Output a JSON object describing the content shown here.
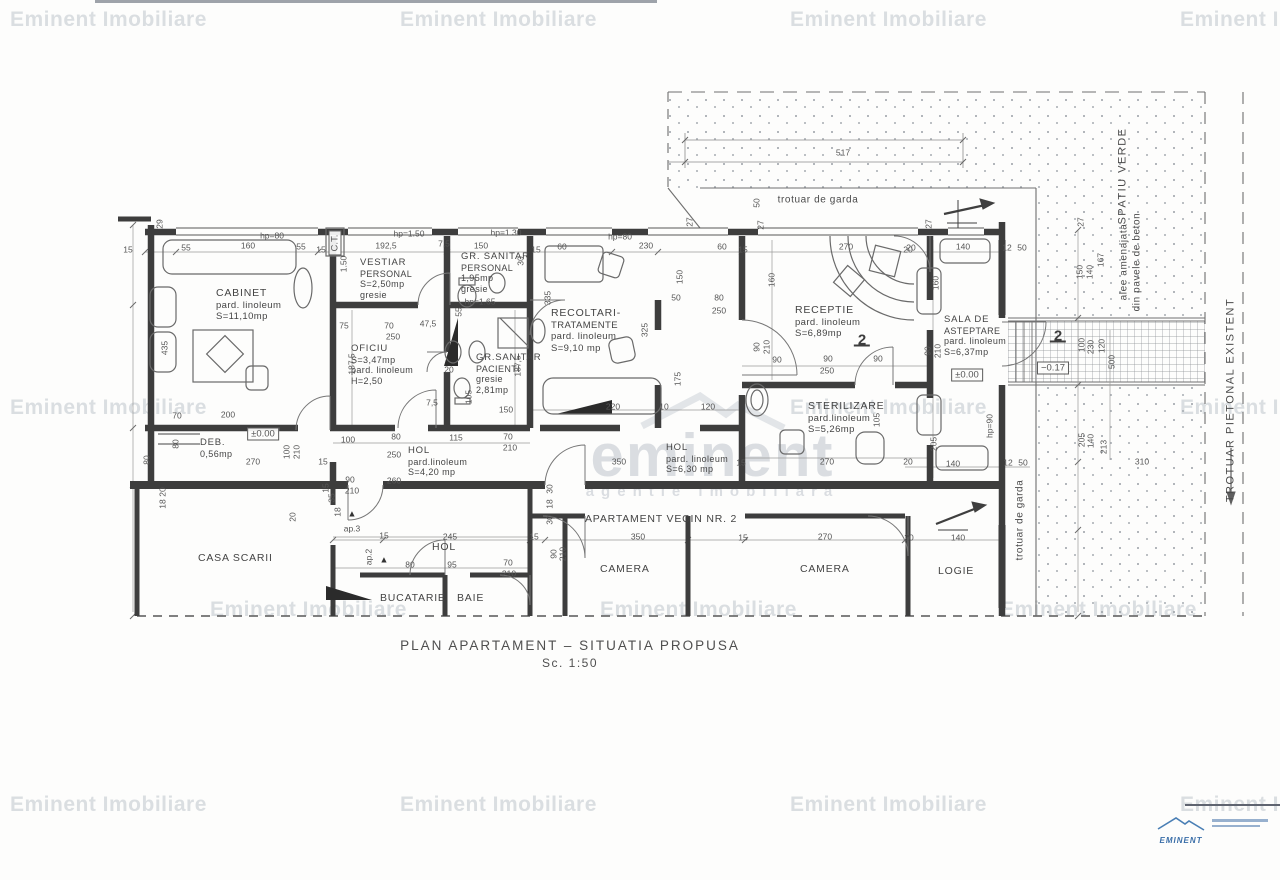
{
  "watermark": {
    "text": "Eminent Imobiliare",
    "tiles": [
      {
        "x": 10,
        "y": 8
      },
      {
        "x": 400,
        "y": 8
      },
      {
        "x": 790,
        "y": 8
      },
      {
        "x": 1180,
        "y": 8
      },
      {
        "x": 10,
        "y": 396
      },
      {
        "x": 790,
        "y": 396
      },
      {
        "x": 1180,
        "y": 396
      },
      {
        "x": 210,
        "y": 598
      },
      {
        "x": 600,
        "y": 598
      },
      {
        "x": 1000,
        "y": 598
      },
      {
        "x": 10,
        "y": 793
      },
      {
        "x": 400,
        "y": 793
      },
      {
        "x": 790,
        "y": 793
      },
      {
        "x": 1180,
        "y": 793
      }
    ]
  },
  "brand_watermark": {
    "word": "eminent",
    "subtitle": "agentie imobiliara"
  },
  "title": {
    "main": "PLAN APARTAMENT – SITUATIA PROPUSA",
    "scale": "Sc. 1:50"
  },
  "logo": {
    "name": "EMINENT"
  },
  "plan": {
    "rooms": [
      {
        "lines": [
          "CABINET",
          "pard. linoleum",
          "S=11,10mp"
        ],
        "x": 216,
        "y": 288
      },
      {
        "lines": [
          "VESTIAR",
          "PERSONAL",
          "S=2,50mp",
          "gresie"
        ],
        "x": 360,
        "y": 258,
        "s": "sm"
      },
      {
        "lines": [
          "GR. SANITAR",
          "PERSONAL",
          "1,95mp",
          "gresie"
        ],
        "x": 461,
        "y": 252,
        "s": "sm"
      },
      {
        "lines": [
          "OFICIU",
          "S=3,47mp",
          "pard. linoleum",
          "H=2,50"
        ],
        "x": 351,
        "y": 344,
        "s": "sm"
      },
      {
        "lines": [
          "GR.SANITAR",
          "PACIENTI",
          "gresie",
          "2,81mp"
        ],
        "x": 476,
        "y": 353,
        "s": "sm"
      },
      {
        "lines": [
          "RECOLTARI-",
          "TRATAMENTE",
          "pard. linoleum",
          "S=9,10 mp"
        ],
        "x": 551,
        "y": 308
      },
      {
        "lines": [
          "RECEPTIE",
          "pard. linoleum",
          "S=6,89mp"
        ],
        "x": 795,
        "y": 305
      },
      {
        "lines": [
          "STERILIZARE",
          "pard.linoleum",
          "S=5,26mp"
        ],
        "x": 808,
        "y": 401
      },
      {
        "lines": [
          "SALA DE",
          "ASTEPTARE",
          "pard. linoleum",
          "S=6,37mp"
        ],
        "x": 944,
        "y": 315,
        "s": "sm"
      },
      {
        "lines": [
          "DEB.",
          "0,56mp"
        ],
        "x": 200,
        "y": 438,
        "s": "sm"
      },
      {
        "lines": [
          "HOL",
          "pard.linoleum",
          "S=4,20 mp"
        ],
        "x": 408,
        "y": 446,
        "s": "sm"
      },
      {
        "lines": [
          "HOL",
          "pard. linoleum",
          "S=6,30 mp"
        ],
        "x": 666,
        "y": 443,
        "s": "sm"
      },
      {
        "lines": [
          "CASA SCARII"
        ],
        "x": 198,
        "y": 553
      },
      {
        "lines": [
          "HOL"
        ],
        "x": 432,
        "y": 542
      },
      {
        "lines": [
          "BUCATARIE"
        ],
        "x": 380,
        "y": 593
      },
      {
        "lines": [
          "BAIE"
        ],
        "x": 457,
        "y": 593
      },
      {
        "lines": [
          "CAMERA"
        ],
        "x": 600,
        "y": 564
      },
      {
        "lines": [
          "CAMERA"
        ],
        "x": 800,
        "y": 564
      },
      {
        "lines": [
          "LOGIE"
        ],
        "x": 938,
        "y": 566
      },
      {
        "lines": [
          "APARTAMENT VECIN NR. 2"
        ],
        "x": 585,
        "y": 514
      }
    ],
    "labels": [
      {
        "t": "29",
        "x": 160,
        "y": 224,
        "r": 1
      },
      {
        "t": "15",
        "x": 128,
        "y": 250
      },
      {
        "t": "55",
        "x": 186,
        "y": 248
      },
      {
        "t": "160",
        "x": 248,
        "y": 246
      },
      {
        "t": "55",
        "x": 301,
        "y": 247
      },
      {
        "t": "15",
        "x": 321,
        "y": 250
      },
      {
        "t": "hp=80",
        "x": 272,
        "y": 236
      },
      {
        "t": "192,5",
        "x": 386,
        "y": 246
      },
      {
        "t": "hp=1.50",
        "x": 409,
        "y": 234
      },
      {
        "t": "7,5",
        "x": 444,
        "y": 244
      },
      {
        "t": "150",
        "x": 481,
        "y": 246
      },
      {
        "t": "hp=1.30",
        "x": 506,
        "y": 233
      },
      {
        "t": "15",
        "x": 536,
        "y": 250
      },
      {
        "t": "60",
        "x": 562,
        "y": 247
      },
      {
        "t": "hp=80",
        "x": 620,
        "y": 237
      },
      {
        "t": "230",
        "x": 646,
        "y": 246
      },
      {
        "t": "60",
        "x": 722,
        "y": 247
      },
      {
        "t": "15",
        "x": 743,
        "y": 250
      },
      {
        "t": "270",
        "x": 846,
        "y": 247
      },
      {
        "t": "20",
        "x": 911,
        "y": 248
      },
      {
        "t": "140",
        "x": 963,
        "y": 247
      },
      {
        "t": "12",
        "x": 1007,
        "y": 248
      },
      {
        "t": "50",
        "x": 1022,
        "y": 248
      },
      {
        "t": "517",
        "x": 843,
        "y": 153
      },
      {
        "t": "50",
        "x": 757,
        "y": 203,
        "r": 1
      },
      {
        "t": "27",
        "x": 761,
        "y": 225,
        "r": 1
      },
      {
        "t": "27",
        "x": 929,
        "y": 224,
        "r": 1
      },
      {
        "t": "27",
        "x": 690,
        "y": 222,
        "r": 1
      },
      {
        "t": "1.50",
        "x": 344,
        "y": 264,
        "r": 1
      },
      {
        "t": "30",
        "x": 521,
        "y": 261,
        "r": 1
      },
      {
        "t": "335",
        "x": 548,
        "y": 298,
        "r": 1
      },
      {
        "t": "150",
        "x": 680,
        "y": 277,
        "r": 1
      },
      {
        "t": "160",
        "x": 772,
        "y": 280,
        "r": 1
      },
      {
        "t": "hp=1.65",
        "x": 480,
        "y": 302
      },
      {
        "t": "435",
        "x": 165,
        "y": 348,
        "r": 1
      },
      {
        "t": "75",
        "x": 344,
        "y": 326
      },
      {
        "t": "70",
        "x": 389,
        "y": 326
      },
      {
        "t": "250",
        "x": 393,
        "y": 337
      },
      {
        "t": "47,5",
        "x": 428,
        "y": 324
      },
      {
        "t": "55",
        "x": 459,
        "y": 312,
        "r": 1
      },
      {
        "t": "187,5",
        "x": 352,
        "y": 364,
        "r": 1
      },
      {
        "t": "187,5",
        "x": 518,
        "y": 366,
        "r": 1
      },
      {
        "t": "20",
        "x": 449,
        "y": 370
      },
      {
        "t": "105",
        "x": 469,
        "y": 397,
        "r": 1
      },
      {
        "t": "7,5",
        "x": 432,
        "y": 403
      },
      {
        "t": "150",
        "x": 506,
        "y": 410
      },
      {
        "t": "325",
        "x": 645,
        "y": 330,
        "r": 1
      },
      {
        "t": "50",
        "x": 676,
        "y": 298
      },
      {
        "t": "80",
        "x": 719,
        "y": 298
      },
      {
        "t": "250",
        "x": 719,
        "y": 311
      },
      {
        "t": "175",
        "x": 678,
        "y": 379,
        "r": 1
      },
      {
        "t": "90",
        "x": 757,
        "y": 347,
        "r": 1
      },
      {
        "t": "210",
        "x": 767,
        "y": 347,
        "r": 1
      },
      {
        "t": "220",
        "x": 613,
        "y": 407
      },
      {
        "t": "10",
        "x": 664,
        "y": 407
      },
      {
        "t": "120",
        "x": 708,
        "y": 407
      },
      {
        "t": "90",
        "x": 777,
        "y": 360
      },
      {
        "t": "90",
        "x": 828,
        "y": 359
      },
      {
        "t": "90",
        "x": 878,
        "y": 359
      },
      {
        "t": "250",
        "x": 827,
        "y": 371
      },
      {
        "t": "105",
        "x": 877,
        "y": 420,
        "r": 1
      },
      {
        "t": "270",
        "x": 827,
        "y": 462
      },
      {
        "t": "15",
        "x": 741,
        "y": 463
      },
      {
        "t": "20",
        "x": 908,
        "y": 462
      },
      {
        "t": "20",
        "x": 908,
        "y": 250
      },
      {
        "t": "160",
        "x": 936,
        "y": 283,
        "r": 1
      },
      {
        "t": "90",
        "x": 928,
        "y": 351,
        "r": 1
      },
      {
        "t": "210",
        "x": 938,
        "y": 351,
        "r": 1
      },
      {
        "t": "205",
        "x": 934,
        "y": 444,
        "r": 1
      },
      {
        "t": "140",
        "x": 953,
        "y": 464
      },
      {
        "t": "12",
        "x": 1008,
        "y": 463
      },
      {
        "t": "50",
        "x": 1023,
        "y": 463
      },
      {
        "t": "hp=90",
        "x": 990,
        "y": 426,
        "r": 1
      },
      {
        "t": "100",
        "x": 348,
        "y": 440
      },
      {
        "t": "80",
        "x": 396,
        "y": 437
      },
      {
        "t": "250",
        "x": 394,
        "y": 455
      },
      {
        "t": "115",
        "x": 456,
        "y": 438
      },
      {
        "t": "70",
        "x": 508,
        "y": 437
      },
      {
        "t": "210",
        "x": 510,
        "y": 448
      },
      {
        "t": "15",
        "x": 323,
        "y": 462
      },
      {
        "t": "260",
        "x": 394,
        "y": 481
      },
      {
        "t": "350",
        "x": 619,
        "y": 462
      },
      {
        "t": "70",
        "x": 177,
        "y": 416
      },
      {
        "t": "200",
        "x": 228,
        "y": 415
      },
      {
        "t": "80",
        "x": 147,
        "y": 460,
        "r": 1
      },
      {
        "t": "270",
        "x": 253,
        "y": 462
      },
      {
        "t": "100",
        "x": 287,
        "y": 452,
        "r": 1
      },
      {
        "t": "210",
        "x": 297,
        "y": 452,
        "r": 1
      },
      {
        "t": "80",
        "x": 176,
        "y": 444,
        "r": 1
      },
      {
        "t": "20",
        "x": 163,
        "y": 492,
        "r": 1
      },
      {
        "t": "18",
        "x": 163,
        "y": 504,
        "r": 1
      },
      {
        "t": "90",
        "x": 350,
        "y": 480
      },
      {
        "t": "210",
        "x": 352,
        "y": 491
      },
      {
        "t": "15",
        "x": 326,
        "y": 488,
        "r": 1
      },
      {
        "t": "35",
        "x": 332,
        "y": 498,
        "r": 1
      },
      {
        "t": "18",
        "x": 338,
        "y": 512,
        "r": 1
      },
      {
        "t": "20",
        "x": 293,
        "y": 517,
        "r": 1
      },
      {
        "t": "245",
        "x": 450,
        "y": 537
      },
      {
        "t": "15",
        "x": 384,
        "y": 536
      },
      {
        "t": "15",
        "x": 534,
        "y": 537
      },
      {
        "t": "80",
        "x": 410,
        "y": 565
      },
      {
        "t": "95",
        "x": 452,
        "y": 565
      },
      {
        "t": "70",
        "x": 508,
        "y": 563
      },
      {
        "t": "210",
        "x": 509,
        "y": 574
      },
      {
        "t": "30",
        "x": 550,
        "y": 489,
        "r": 1
      },
      {
        "t": "18",
        "x": 550,
        "y": 504,
        "r": 1
      },
      {
        "t": "30",
        "x": 550,
        "y": 520,
        "r": 1
      },
      {
        "t": "90",
        "x": 554,
        "y": 554,
        "r": 1
      },
      {
        "t": "210",
        "x": 563,
        "y": 554,
        "r": 1
      },
      {
        "t": "350",
        "x": 638,
        "y": 537
      },
      {
        "t": "15",
        "x": 743,
        "y": 538
      },
      {
        "t": "270",
        "x": 825,
        "y": 537
      },
      {
        "t": "20",
        "x": 909,
        "y": 538
      },
      {
        "t": "140",
        "x": 958,
        "y": 538
      },
      {
        "t": "150",
        "x": 1080,
        "y": 272,
        "r": 1
      },
      {
        "t": "140",
        "x": 1090,
        "y": 272,
        "r": 1
      },
      {
        "t": "167",
        "x": 1101,
        "y": 260,
        "r": 1
      },
      {
        "t": "27",
        "x": 1081,
        "y": 222,
        "r": 1
      },
      {
        "t": "100",
        "x": 1082,
        "y": 345,
        "r": 1
      },
      {
        "t": "230",
        "x": 1091,
        "y": 347,
        "r": 1
      },
      {
        "t": "120",
        "x": 1102,
        "y": 346,
        "r": 1
      },
      {
        "t": "500",
        "x": 1112,
        "y": 362,
        "r": 1
      },
      {
        "t": "205",
        "x": 1082,
        "y": 440,
        "r": 1
      },
      {
        "t": "140",
        "x": 1091,
        "y": 441,
        "r": 1
      },
      {
        "t": "213",
        "x": 1104,
        "y": 447,
        "r": 1
      },
      {
        "t": "310",
        "x": 1142,
        "y": 462
      },
      {
        "t": "C.T.",
        "x": 335,
        "y": 243,
        "r": 1,
        "c": "box"
      },
      {
        "t": "±0.00",
        "x": 263,
        "y": 434,
        "c": "box"
      },
      {
        "t": "±0.00",
        "x": 967,
        "y": 375,
        "c": "box"
      },
      {
        "t": "−0.17",
        "x": 1053,
        "y": 368,
        "c": "box"
      },
      {
        "t": "2",
        "x": 862,
        "y": 341,
        "c": "sec"
      },
      {
        "t": "2",
        "x": 1058,
        "y": 337,
        "c": "sec"
      },
      {
        "t": "ap.3",
        "x": 352,
        "y": 529
      },
      {
        "t": "▲",
        "x": 352,
        "y": 514,
        "c": "tri"
      },
      {
        "t": "ap.2",
        "x": 369,
        "y": 557,
        "r": 1
      },
      {
        "t": "▲",
        "x": 384,
        "y": 560,
        "c": "tri"
      },
      {
        "t": "trotuar de garda",
        "x": 818,
        "y": 200,
        "c": "site-sm"
      },
      {
        "t": "trotuar de garda",
        "x": 1020,
        "y": 520,
        "r": 1,
        "c": "site-sm"
      },
      {
        "t": "alee amenajata",
        "x": 1124,
        "y": 262,
        "r": 1,
        "c": "site-sm"
      },
      {
        "t": "din pavele de beton",
        "x": 1137,
        "y": 262,
        "r": 1,
        "c": "site-sm"
      },
      {
        "t": "SPATIU VERDE",
        "x": 1123,
        "y": 176,
        "r": 1,
        "c": "site"
      },
      {
        "t": "TROTUAR PIETONAL EXISTENT",
        "x": 1231,
        "y": 400,
        "r": 1,
        "c": "site"
      }
    ]
  }
}
